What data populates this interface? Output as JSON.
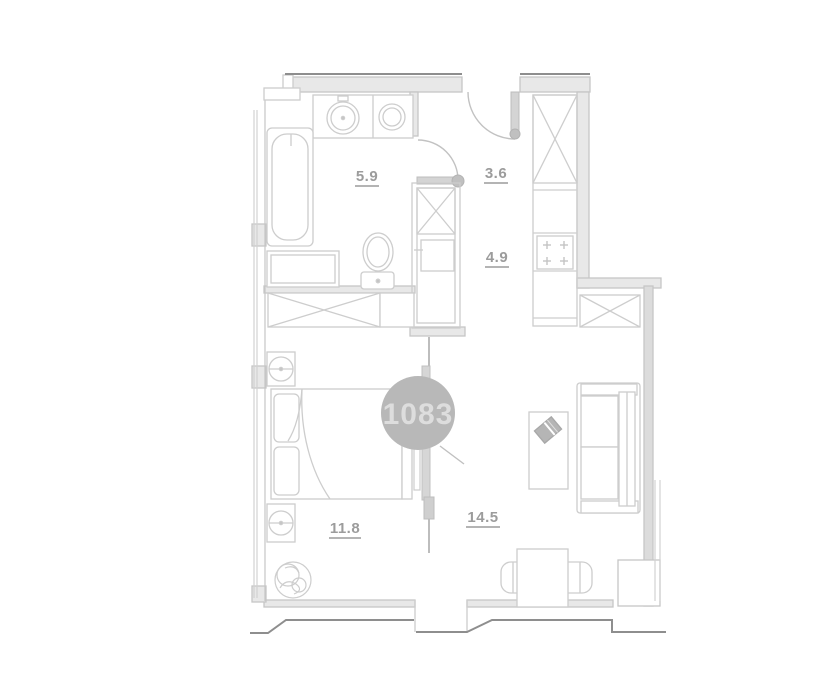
{
  "plan": {
    "unit_badge": "1083",
    "rooms": [
      {
        "id": "bathroom",
        "area": "5.9"
      },
      {
        "id": "hallway",
        "area": "3.6"
      },
      {
        "id": "kitchen",
        "area": "4.9"
      },
      {
        "id": "bedroom",
        "area": "11.8"
      },
      {
        "id": "living-room",
        "area": "14.5"
      }
    ],
    "colors": {
      "background": "#ffffff",
      "wall_line": "#c6c6c6",
      "wall_fill": "#e8e8e8",
      "furniture_line": "#cdcdcd",
      "outline_dark": "#8e8e8e",
      "label_text": "#9c9c9c",
      "badge_fill": "#b8b8b8",
      "badge_text": "#dddddd"
    }
  }
}
